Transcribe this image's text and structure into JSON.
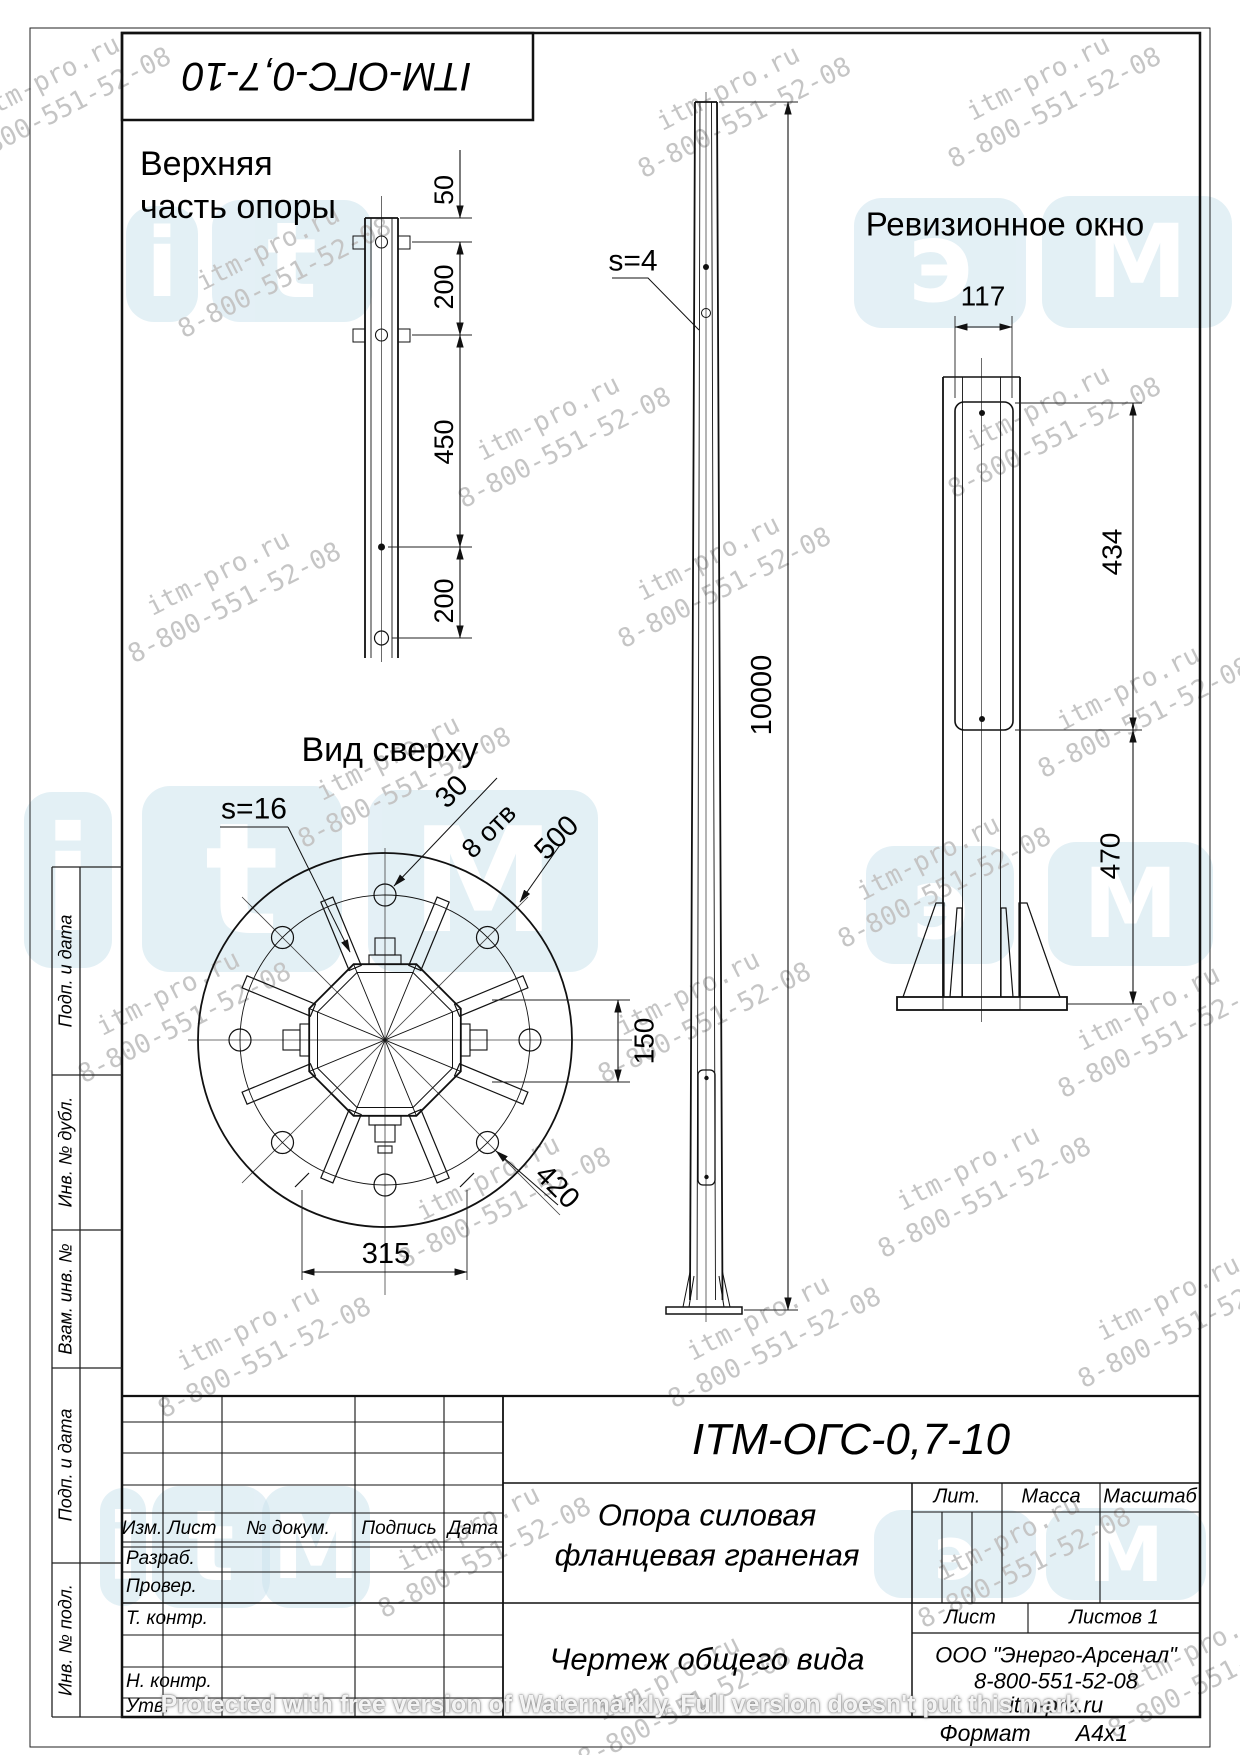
{
  "sheet": {
    "top_stamp": "ITM-ОГС-0,7-10",
    "format_label": "Формат",
    "format_value": "A4x1",
    "protection_note": "Protected with free version of Watermarkly. Full version doesn't put this mark"
  },
  "views": {
    "upper": {
      "title1": "Верхняя",
      "title2": "часть опоры",
      "dim_top": "50",
      "dim_bolt1": "200",
      "dim_mid": "450",
      "dim_bot": "200"
    },
    "main": {
      "wall_label": "s=4",
      "height": "10000"
    },
    "revision": {
      "title": "Ревизионное окно",
      "dim_width": "117",
      "dim_window": "434",
      "dim_bottom": "470"
    },
    "top_view": {
      "title": "Вид сверху",
      "wall_label": "s=16",
      "dim_hole": "30",
      "holes_note": "8 отв",
      "dim_outer": "500",
      "dim_bolt_circle": "420",
      "dim_across": "150",
      "dim_span": "315"
    }
  },
  "title_block": {
    "designation": "ITM-ОГС-0,7-10",
    "name1": "Опора силовая",
    "name2": "фланцевая граненая",
    "doc_type": "Чертеж общего вида",
    "company": "ООО \"Энерго-Арсенал\"",
    "phone": "8-800-551-52-08",
    "site": "itm-pro.ru",
    "col_izm": "Изм.",
    "col_list": "Лист",
    "col_doc": "№ докум.",
    "col_sign": "Подпись",
    "col_date": "Дата",
    "row_razrab": "Разраб.",
    "row_prover": "Провер.",
    "row_tkontr": "Т. контр.",
    "row_nkontr": "Н. контр.",
    "row_utv": "Утв.",
    "lit": "Лит.",
    "massa": "Масса",
    "masshtab": "Масштаб",
    "list": "Лист",
    "listov": "Листов 1"
  },
  "margin_column": {
    "c1": "Подп. и дата",
    "c2": "Инв. № дубл.",
    "c3": "Взам. инв. №",
    "c4": "Подп. и дата",
    "c5": "Инв. № подл."
  },
  "watermark": {
    "site": "itm-pro.ru",
    "phone": "8-800-551-52-08",
    "logo_i": "i",
    "logo_t": "t",
    "logo_m": "M",
    "logo_e": "э",
    "tile_color": "#cde4ee",
    "text_color": "#c5c5c5"
  }
}
